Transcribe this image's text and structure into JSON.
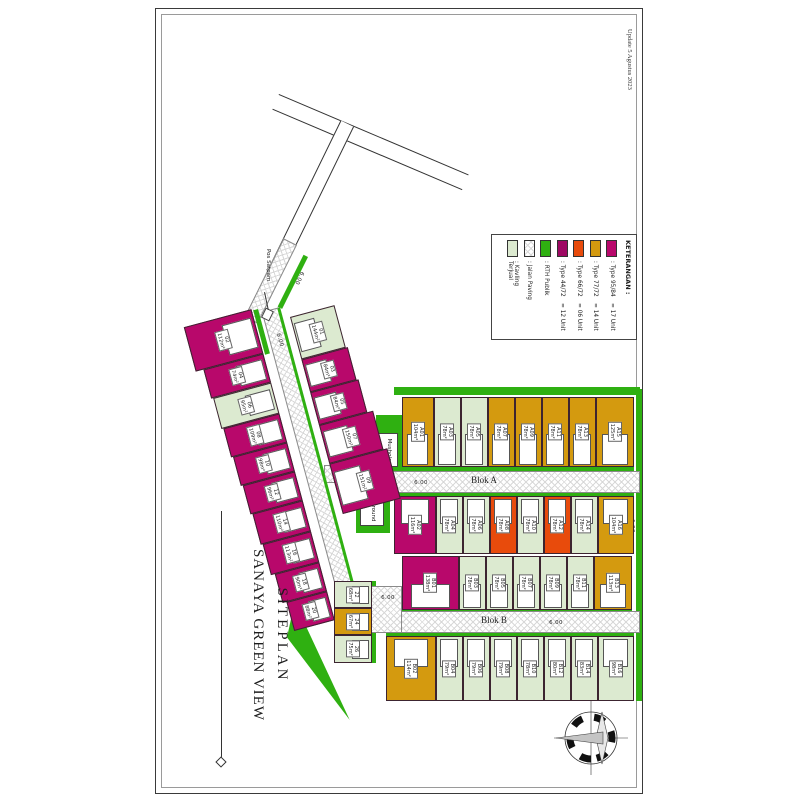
{
  "sheet": {
    "update_note": "Update 5 Agustus 2023"
  },
  "title": {
    "line1": "SITEPLAN",
    "line2": "SANAYA GREEN VIEW"
  },
  "legend": {
    "title": "KETERANGAN :",
    "items": [
      {
        "type": "t95",
        "label": ": Type 95/84",
        "count": "= 17 Unit"
      },
      {
        "type": "t77",
        "label": ": Type 77/72",
        "count": "= 14 Unit"
      },
      {
        "type": "t66",
        "label": ": Type 66/72",
        "count": "= 06 Unit"
      },
      {
        "type": "t44",
        "label": ": Type 44/72",
        "count": "= 12 Unit"
      },
      {
        "type": "rth",
        "label": ": RTH Publik",
        "count": ""
      },
      {
        "type": "paving",
        "label": ": Jalan Paving",
        "count": ""
      },
      {
        "type": "sold",
        "label": ": Kavling Terjual",
        "count": ""
      }
    ]
  },
  "colors": {
    "t95": "#b8086b",
    "t77": "#d49a0f",
    "t66": "#e84b0c",
    "t44": "#9e0863",
    "rth": "#2fb011",
    "sold": "#dcead0"
  },
  "streets": {
    "blok_a": "Blok A",
    "blok_b": "Blok B"
  },
  "facilities": {
    "mushola": "Mushola",
    "playground": "Playground",
    "pos_satpam": "Pos Satpam"
  },
  "dimensions": {
    "road_width": "6.00"
  },
  "lots": {
    "blok_a_north": [
      {
        "id": "A15",
        "area": "125m²",
        "type": "t77"
      },
      {
        "id": "A13",
        "area": "78m²",
        "type": "t77"
      },
      {
        "id": "A11",
        "area": "78m²",
        "type": "t77"
      },
      {
        "id": "A09",
        "area": "78m²",
        "type": "t77"
      },
      {
        "id": "A07",
        "area": "78m²",
        "type": "t77"
      },
      {
        "id": "A05",
        "area": "78m²",
        "type": "sold"
      },
      {
        "id": "A03",
        "area": "78m²",
        "type": "sold"
      },
      {
        "id": "A01",
        "area": "104m²",
        "type": "t77"
      }
    ],
    "blok_a_south": [
      {
        "id": "A16",
        "area": "104m²",
        "type": "t77"
      },
      {
        "id": "A14",
        "area": "78m²",
        "type": "sold"
      },
      {
        "id": "A12",
        "area": "78m²",
        "type": "t66"
      },
      {
        "id": "A10",
        "area": "78m²",
        "type": "sold"
      },
      {
        "id": "A08",
        "area": "78m²",
        "type": "t66"
      },
      {
        "id": "A06",
        "area": "78m²",
        "type": "sold"
      },
      {
        "id": "A04",
        "area": "78m²",
        "type": "sold"
      },
      {
        "id": "A02",
        "area": "116m²",
        "type": "t95"
      }
    ],
    "blok_b_north": [
      {
        "id": "B13",
        "area": "113m²",
        "type": "t77"
      },
      {
        "id": "B11",
        "area": "78m²",
        "type": "sold"
      },
      {
        "id": "B09",
        "area": "78m²",
        "type": "sold"
      },
      {
        "id": "B07",
        "area": "78m²",
        "type": "sold"
      },
      {
        "id": "B05",
        "area": "78m²",
        "type": "sold"
      },
      {
        "id": "B03",
        "area": "78m²",
        "type": "sold"
      },
      {
        "id": "B01",
        "area": "138m²",
        "type": "t95"
      }
    ],
    "blok_b_south": [
      {
        "id": "B16",
        "area": "98m²",
        "type": "sold"
      },
      {
        "id": "B14",
        "area": "83m²",
        "type": "sold"
      },
      {
        "id": "B12",
        "area": "80m²",
        "type": "sold"
      },
      {
        "id": "B10",
        "area": "78m²",
        "type": "sold"
      },
      {
        "id": "B08",
        "area": "79m²",
        "type": "sold"
      },
      {
        "id": "B06",
        "area": "79m²",
        "type": "sold"
      },
      {
        "id": "B04",
        "area": "79m²",
        "type": "sold"
      },
      {
        "id": "B02",
        "area": "114m²",
        "type": "t77"
      }
    ],
    "south_strip": [
      {
        "id": "22",
        "area": "68m²",
        "type": "sold"
      },
      {
        "id": "24",
        "area": "67m²",
        "type": "t77"
      },
      {
        "id": "26",
        "area": "75m²",
        "type": "sold"
      }
    ],
    "hill_upper": [
      {
        "id": "01",
        "area": "144m²",
        "type": "sold"
      },
      {
        "id": "03",
        "area": "84m²",
        "type": "t95"
      },
      {
        "id": "05",
        "area": "84m²",
        "type": "t95"
      },
      {
        "id": "07",
        "area": "150m²",
        "type": "t95"
      },
      {
        "id": "09",
        "area": "151m²",
        "type": "t95"
      }
    ],
    "hill_lower": [
      {
        "id": "02",
        "area": "112m²",
        "type": "t95"
      },
      {
        "id": "04",
        "area": "74m²",
        "type": "t95"
      },
      {
        "id": "06",
        "area": "95m²",
        "type": "sold"
      },
      {
        "id": "08",
        "area": "109m²",
        "type": "t95"
      },
      {
        "id": "10",
        "area": "98m²",
        "type": "t95"
      },
      {
        "id": "12",
        "area": "96m²",
        "type": "t95"
      },
      {
        "id": "14",
        "area": "110m²",
        "type": "t95"
      },
      {
        "id": "16",
        "area": "113m²",
        "type": "t95"
      },
      {
        "id": "18",
        "area": "90m²",
        "type": "t95"
      },
      {
        "id": "20",
        "area": "88m²",
        "type": "t95"
      }
    ]
  }
}
